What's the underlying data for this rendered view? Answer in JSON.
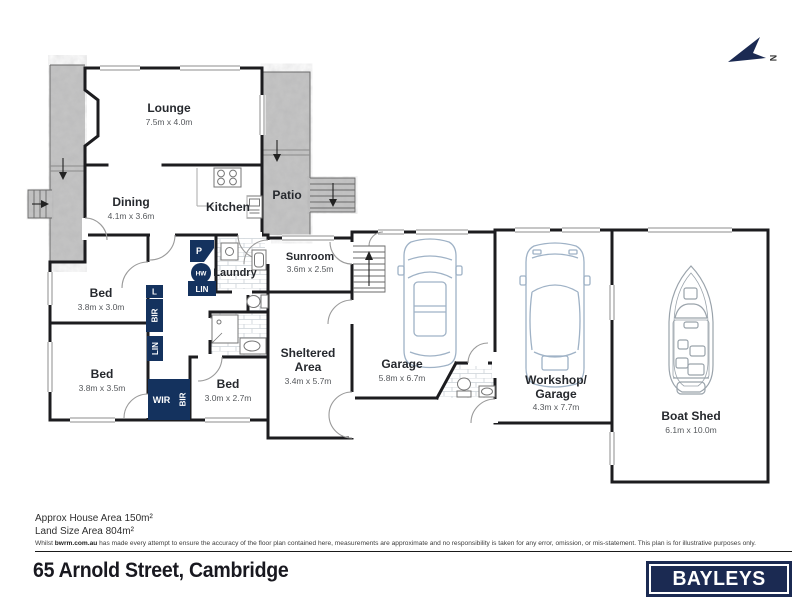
{
  "plan": {
    "north_label": "N",
    "rooms": {
      "lounge": {
        "name": "Lounge",
        "dims": "7.5m x 4.0m"
      },
      "dining": {
        "name": "Dining",
        "dims": "4.1m x 3.6m"
      },
      "kitchen": {
        "name": "Kitchen"
      },
      "patio": {
        "name": "Patio"
      },
      "sunroom": {
        "name": "Sunroom",
        "dims": "3.6m x 2.5m"
      },
      "laundry": {
        "name": "Laundry"
      },
      "bed1": {
        "name": "Bed",
        "dims": "3.8m x 3.0m"
      },
      "bed2": {
        "name": "Bed",
        "dims": "3.8m x 3.5m"
      },
      "bed3": {
        "name": "Bed",
        "dims": "3.0m x 2.7m"
      },
      "sheltered": {
        "line1": "Sheltered",
        "line2": "Area",
        "dims": "3.4m x 5.7m"
      },
      "garage": {
        "name": "Garage",
        "dims": "5.8m x 6.7m"
      },
      "workshop": {
        "line1": "Workshop/",
        "line2": "Garage",
        "dims": "4.3m x 7.7m"
      },
      "boatshed": {
        "name": "Boat Shed",
        "dims": "6.1m x 10.0m"
      }
    },
    "closets": {
      "pantry": "P",
      "hot_water": "HW",
      "linen1": "LIN",
      "linen_small": "L",
      "bir1": "BIR",
      "linen2": "LIN",
      "wir": "WIR",
      "bir2": "BIR"
    }
  },
  "footer": {
    "house_area": "Approx House Area 150m²",
    "land_area": "Land Size Area 804m²",
    "disclaimer_prefix": "Whilst ",
    "disclaimer_brand": "bwrm.com.au",
    "disclaimer_rest": " has made every attempt to ensure the accuracy of the floor plan contained here, measurements are approximate and no responsibility is taken for any error, omission, or mis-statement. This plan is for illustrative purposes only.",
    "address": "65 Arnold Street, Cambridge",
    "logo_text": "BAYLEYS"
  },
  "colors": {
    "navy": "#14325e",
    "logo_navy": "#1b2a52",
    "wall": "#1c1c1f",
    "concrete": "#c6c6c6",
    "car_outline": "#9fb2c6",
    "boat_outline": "#9aa3ab"
  }
}
